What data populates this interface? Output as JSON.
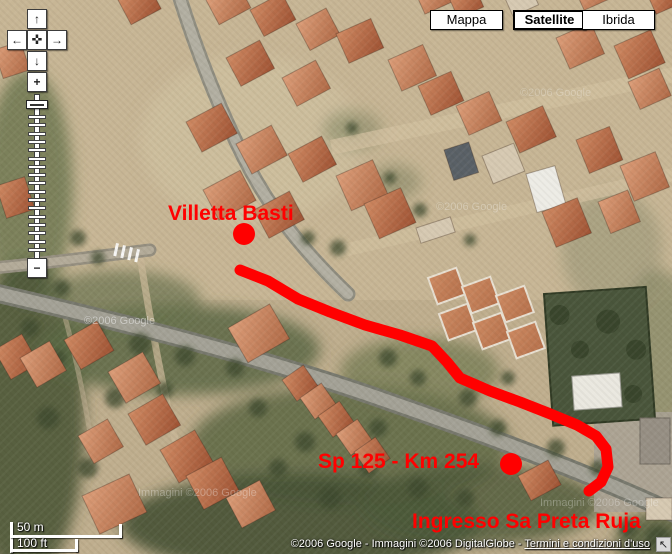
{
  "map_type_buttons": [
    {
      "label": "Mappa",
      "selected": false
    },
    {
      "label": "Satellite",
      "selected": true
    },
    {
      "label": "Ibrida",
      "selected": false
    }
  ],
  "map_controls": {
    "icons": {
      "pan_up": "↑",
      "pan_down": "↓",
      "pan_left": "←",
      "pan_right": "→",
      "center": "✜",
      "zoom_in": "+",
      "zoom_out": "−",
      "cursor": "↖"
    }
  },
  "annotations": {
    "color": "#ff0000",
    "labels": [
      {
        "name": "villetta-basti",
        "text": "Villetta Basti",
        "x": 168,
        "y": 203
      },
      {
        "name": "sp125-km254",
        "text": "Sp 125 - Km 254",
        "x": 318,
        "y": 451
      },
      {
        "name": "ingresso",
        "text": "Ingresso Sa Preta Ruja",
        "x": 412,
        "y": 511
      }
    ],
    "markers": [
      {
        "name": "villetta-basti-dot",
        "x": 244,
        "y": 234,
        "r": 11
      },
      {
        "name": "sp125-dot",
        "x": 511,
        "y": 464,
        "r": 11
      }
    ],
    "route": {
      "width": 11,
      "points": [
        [
          240,
          270
        ],
        [
          268,
          281
        ],
        [
          298,
          299
        ],
        [
          330,
          312
        ],
        [
          365,
          325
        ],
        [
          400,
          335
        ],
        [
          432,
          346
        ],
        [
          447,
          362
        ],
        [
          460,
          378
        ],
        [
          490,
          391
        ],
        [
          520,
          402
        ],
        [
          548,
          413
        ],
        [
          577,
          425
        ],
        [
          596,
          436
        ],
        [
          606,
          449
        ],
        [
          608,
          467
        ],
        [
          601,
          482
        ],
        [
          589,
          491
        ]
      ]
    }
  },
  "scale_bar": {
    "metric": "50 m",
    "imperial": "100 ft"
  },
  "attribution": {
    "prefix": "©2006 Google - Immagini ©2006 DigitalGlobe - ",
    "link_label": "Termini e condizioni d'uso"
  },
  "watermarks": [
    {
      "text": "©2006 Google",
      "x": 84,
      "y": 316,
      "opacity": 0.45
    },
    {
      "text": "©2006 Google",
      "x": 436,
      "y": 202,
      "opacity": 0.28
    },
    {
      "text": "©2006 Google",
      "x": 520,
      "y": 88,
      "opacity": 0.24
    },
    {
      "text": "Immagini ©2006 Google",
      "x": 138,
      "y": 488,
      "opacity": 0.3
    },
    {
      "text": "Immagini ©2006 Google",
      "x": 540,
      "y": 498,
      "opacity": 0.28
    }
  ]
}
